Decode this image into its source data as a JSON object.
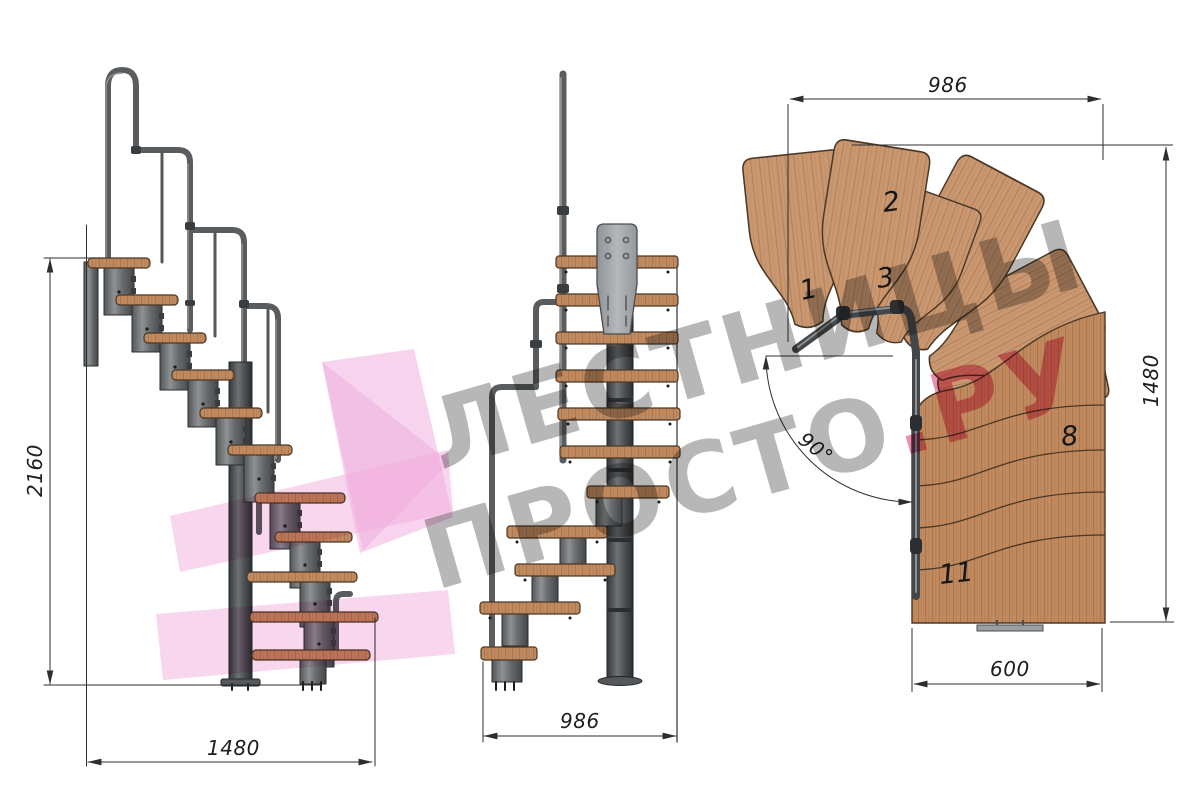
{
  "drawing": {
    "side_view": {
      "height_dim": "2160",
      "width_dim": "1480"
    },
    "front_view": {
      "width_dim": "986"
    },
    "plan_view": {
      "top_dim": "986",
      "right_dim": "1480",
      "bottom_dim": "600",
      "angle_dim": "90°",
      "tread_1": "1",
      "tread_2": "2",
      "tread_3": "3",
      "tread_8": "8",
      "tread_11": "11"
    },
    "watermark": {
      "line1": "ЛЕСТНИЦЫ",
      "line2_gray": "ПРОСТО",
      "line2_accent": ".РУ"
    },
    "colors": {
      "wood": "#c18a5e",
      "wood_dark_edge": "#4a3826",
      "metal": "#6a6d6f",
      "metal_dark": "#3d4043",
      "plate_gray": "#a4a8ab",
      "dimension_line": "#2e2e2e",
      "watermark_gray": "#7d7d7d",
      "watermark_pink_text": "#e0497e",
      "watermark_pink_shape": "#f2aede"
    }
  }
}
